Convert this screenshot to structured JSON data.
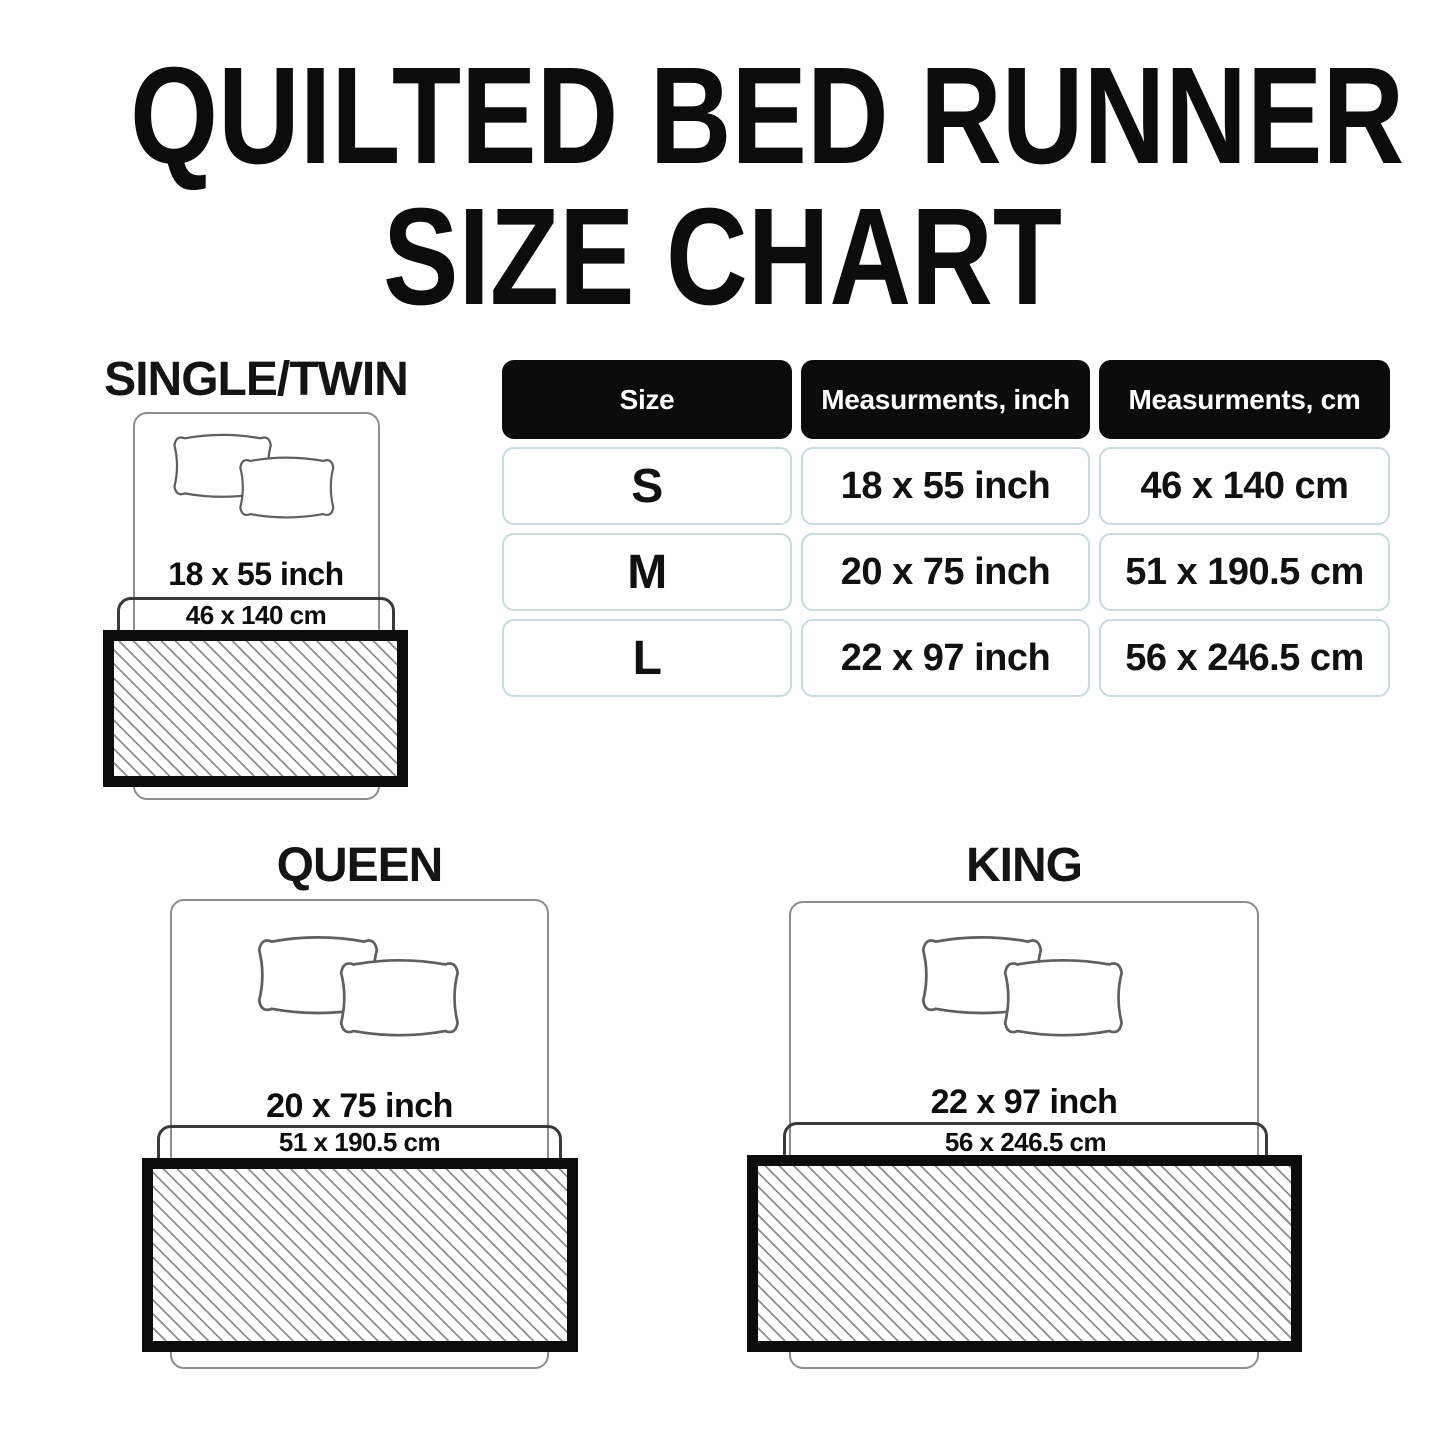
{
  "title": {
    "line1": "QUILTED BED RUNNER",
    "line2": "SIZE CHART"
  },
  "table": {
    "headers": [
      "Size",
      "Measurments, inch",
      "Measurments, cm"
    ],
    "rows": [
      {
        "size": "S",
        "inch": "18 x 55 inch",
        "cm": "46 x 140 cm"
      },
      {
        "size": "M",
        "inch": "20 x 75 inch",
        "cm": "51 x 190.5 cm"
      },
      {
        "size": "L",
        "inch": "22 x 97 inch",
        "cm": "56 x 246.5 cm"
      }
    ]
  },
  "diagrams": {
    "single": {
      "label": "SINGLE/TWIN",
      "inch": "18 x 55 inch",
      "cm": "46 x 140 cm"
    },
    "queen": {
      "label": "QUEEN",
      "inch": "20 x 75 inch",
      "cm": "51 x 190.5 cm"
    },
    "king": {
      "label": "KING",
      "inch": "22 x 97 inch",
      "cm": "56 x 246.5 cm"
    }
  },
  "colors": {
    "text": "#0d0d0d",
    "table_header_bg": "#0b0b0b",
    "table_header_text": "#ffffff",
    "table_cell_border": "#c9dade",
    "bed_outline": "#8d8d8d",
    "band_outline": "#3a3a3a",
    "runner_border": "#0c0c0c",
    "hatch_line": "#8f8f8f"
  }
}
